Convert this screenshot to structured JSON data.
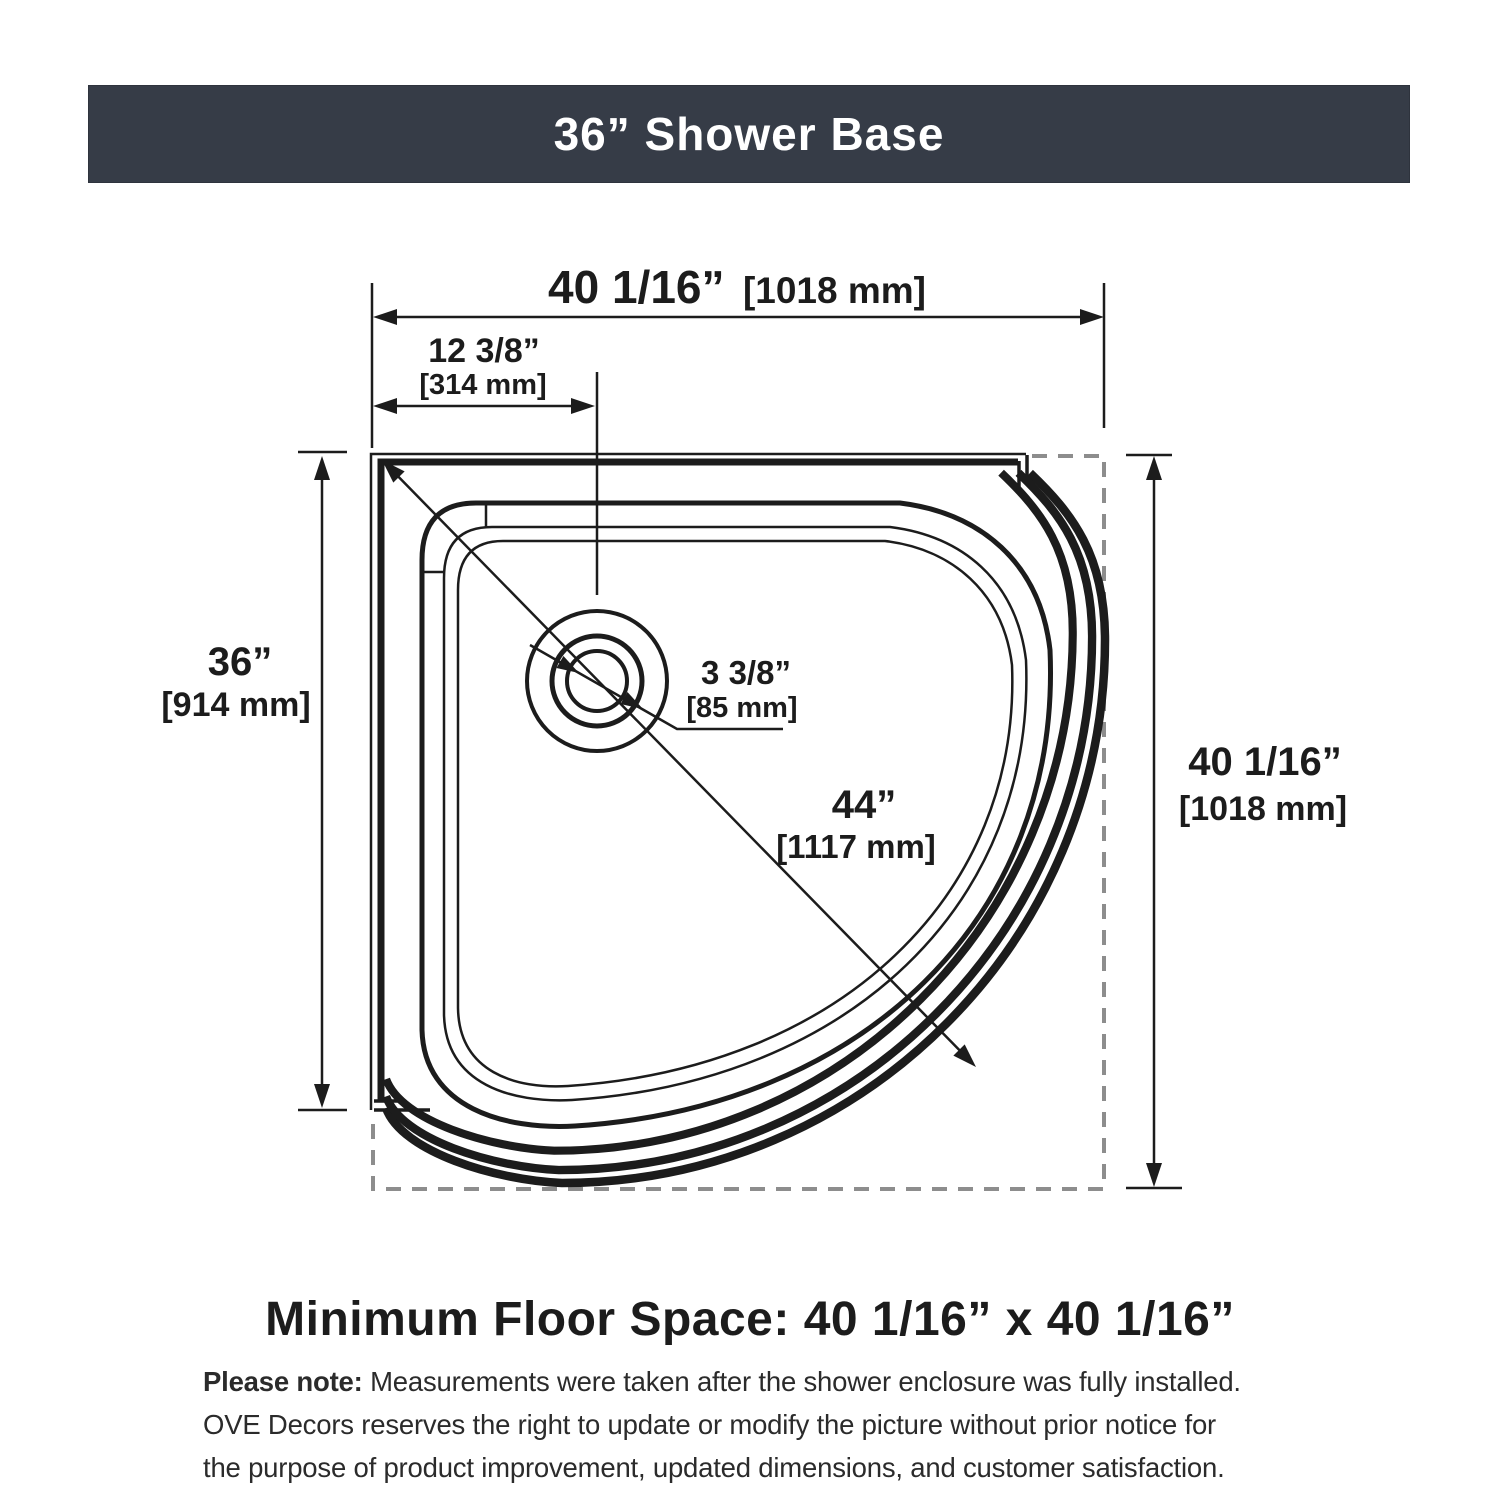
{
  "colors": {
    "line": "#1c1c1c",
    "dash": "#8d8d8d",
    "header_bg": "#363c47",
    "header_text": "#ffffff"
  },
  "header": {
    "title": "36” Shower Base"
  },
  "drawing": {
    "dim_top_width": {
      "in": "40 1/16”",
      "mm": "[1018 mm]"
    },
    "dim_drain_offset": {
      "in": "12 3/8”",
      "mm": "[314 mm]"
    },
    "dim_left_height": {
      "in": "36”",
      "mm": "[914 mm]"
    },
    "dim_right_height": {
      "in": "40 1/16”",
      "mm": "[1018 mm]"
    },
    "dim_drain_diameter": {
      "in": "3 3/8”",
      "mm": "[85 mm]"
    },
    "dim_diagonal": {
      "in": "44”",
      "mm": "[1117 mm]"
    }
  },
  "footer": {
    "heading": "Minimum Floor Space: 40 1/16” x 40 1/16”",
    "note_bold": "Please note:",
    "note_lines": [
      "Measurements were taken after the shower enclosure was fully installed.",
      "OVE Decors reserves the right to update or modify the picture without prior notice for",
      "the purpose of product improvement, updated dimensions, and customer satisfaction."
    ]
  }
}
